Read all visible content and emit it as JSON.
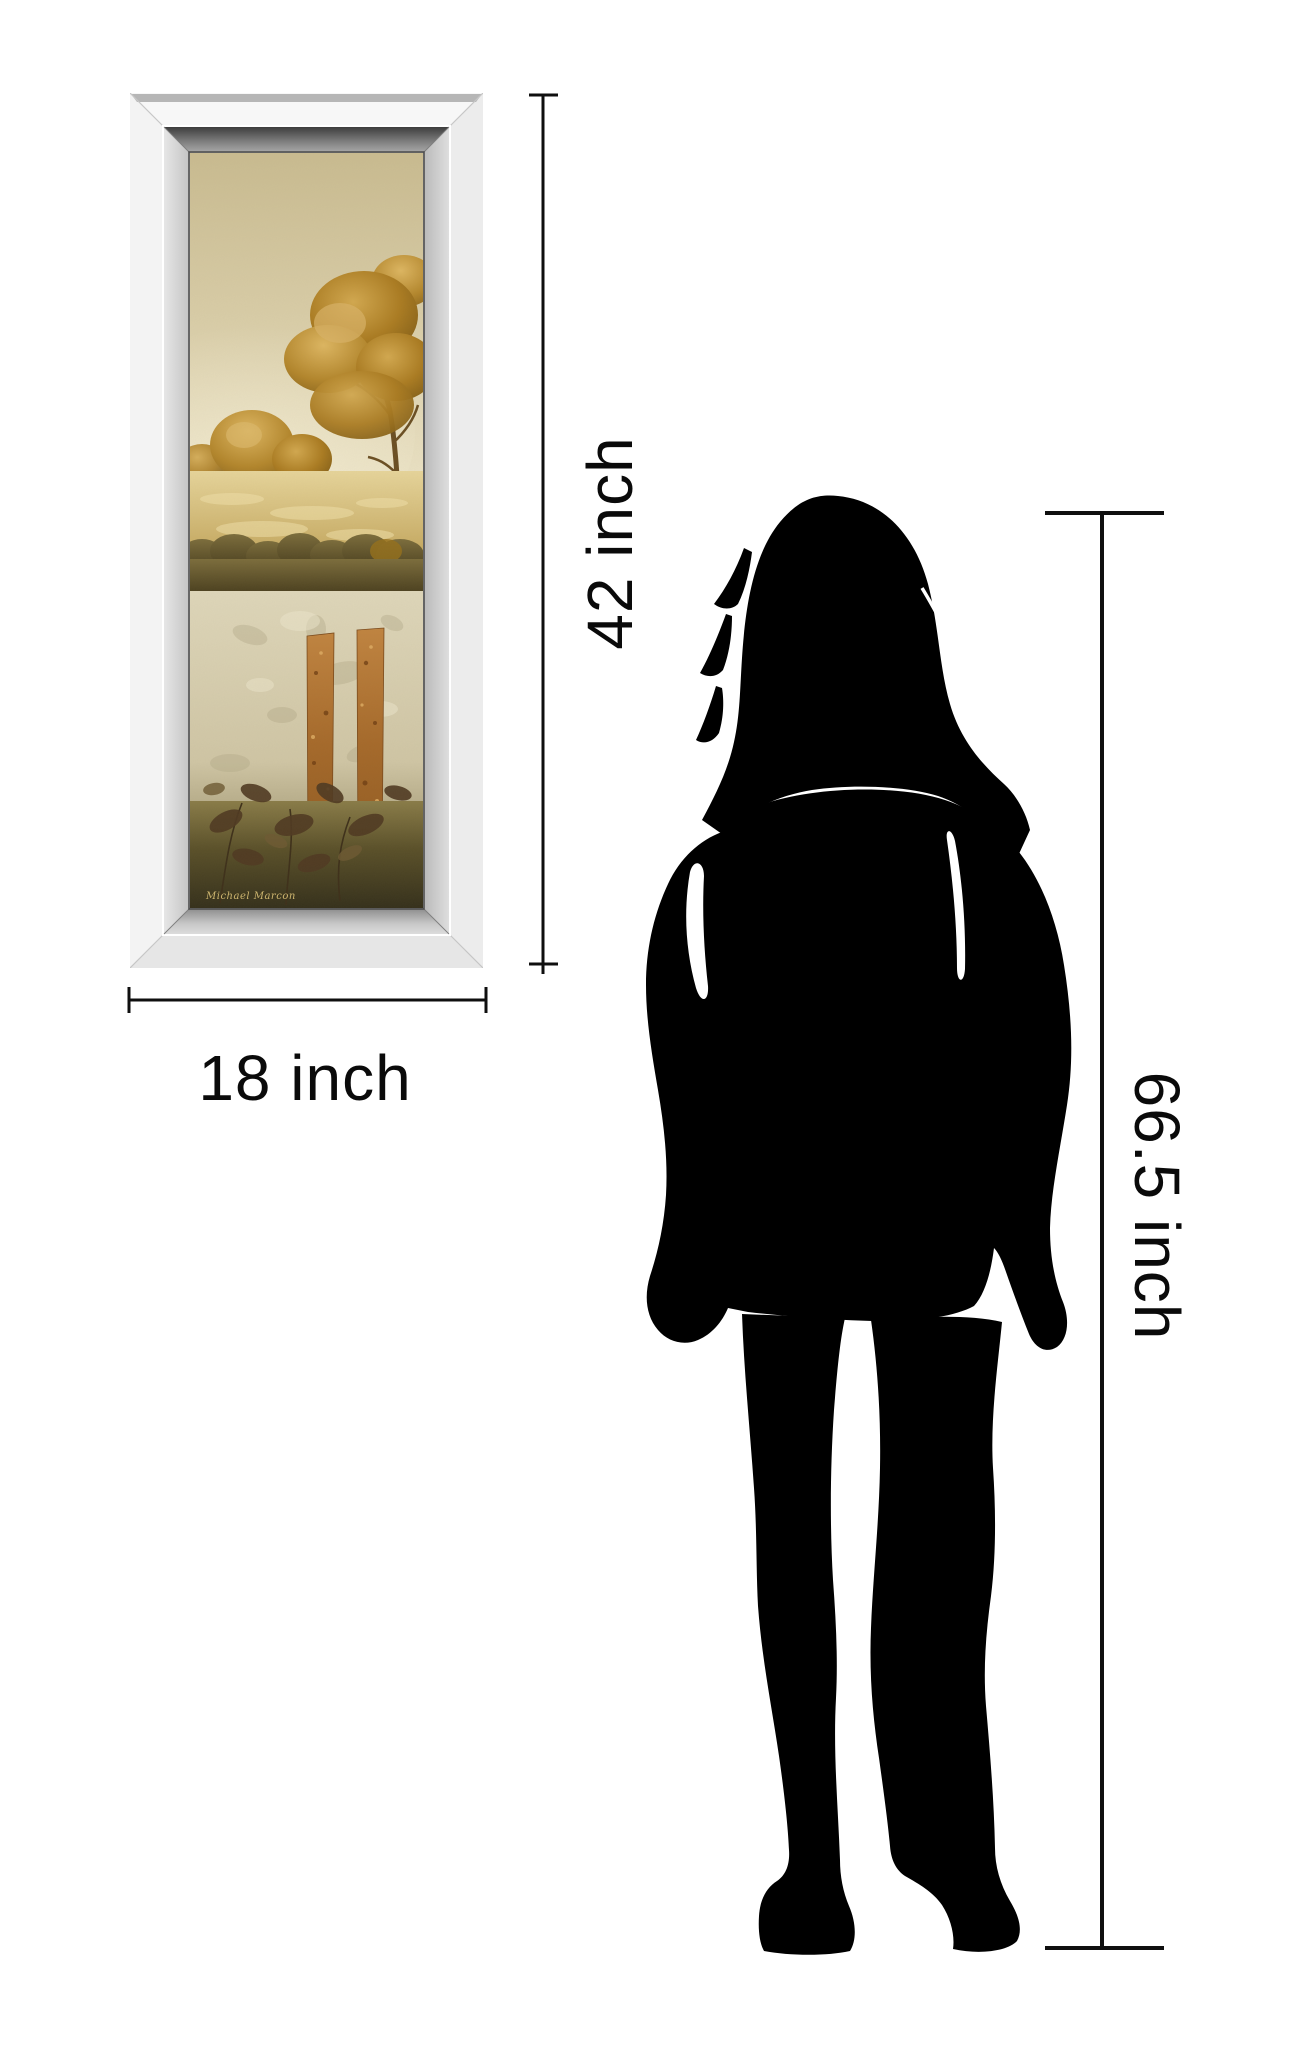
{
  "scene": {
    "description": "Product size comparison diagram: mirrored-frame landscape wall art beside a woman silhouette with dimension lines",
    "background_color": "#ffffff",
    "line_color": "#0a0a0a"
  },
  "artwork": {
    "frame_style": "mirrored bevel frame",
    "signature": "Michael Marcon",
    "colors": {
      "frame_light": "#f4f4f4",
      "frame_bevel_dark": "#454545",
      "sky_beige": "#d5c9a1",
      "tree_gold": "#b8862f",
      "meadow_gold": "#d9c582",
      "hedge_olive": "#5c5029",
      "wall_cream": "#d9d1b3",
      "bar_rust": "#a86a2c",
      "ground_olive": "#4a4226"
    }
  },
  "measurements": {
    "artwork_height": "42 inch",
    "artwork_width": "18 inch",
    "person_height": "66.5 inch"
  },
  "person": {
    "type": "woman silhouette",
    "color": "#000000"
  }
}
